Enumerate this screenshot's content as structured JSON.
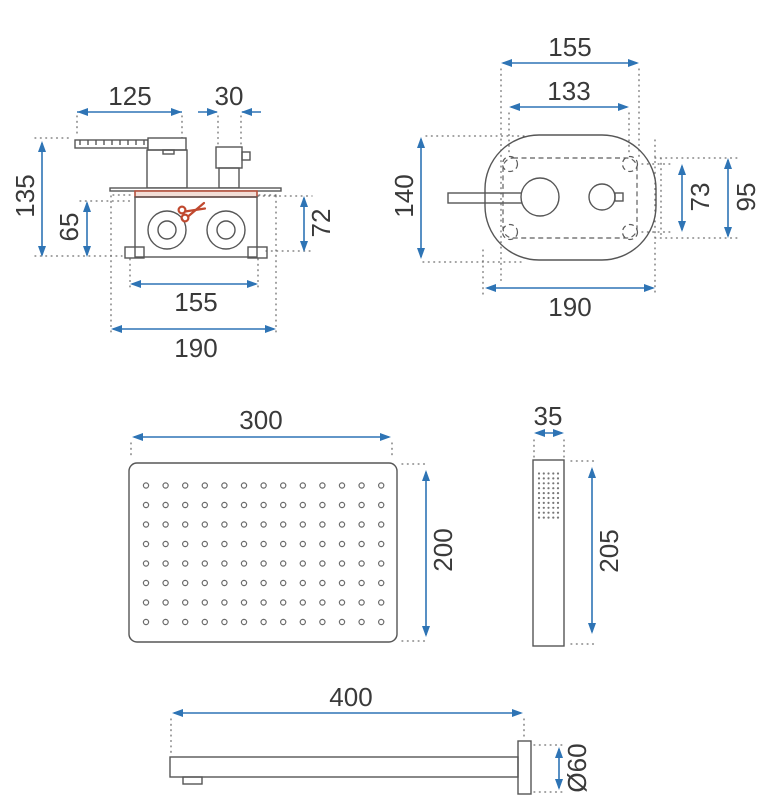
{
  "drawing_title": "shower-set-dimension-drawing",
  "colors": {
    "dimension_blue": "#2e74b5",
    "outline_gray": "#565656",
    "cut_line_red": "#b5503c",
    "scissors_red": "#c0492f"
  },
  "mixer_side_view": {
    "handle_length": "125",
    "diverter_width": "30",
    "total_height": "135",
    "body_height": "65",
    "body_depth": "72",
    "body_width": "155",
    "flange_width": "190"
  },
  "mixer_front_view": {
    "plate_width": "155",
    "holes_width": "133",
    "plate_height": "140",
    "holes_height": "73",
    "inner_height": "95",
    "flange_width": "190"
  },
  "rain_shower_head": {
    "width": "300",
    "height": "200"
  },
  "hand_shower": {
    "width": "35",
    "length": "205"
  },
  "wall_spout": {
    "length": "400",
    "diameter": "Ø60"
  }
}
